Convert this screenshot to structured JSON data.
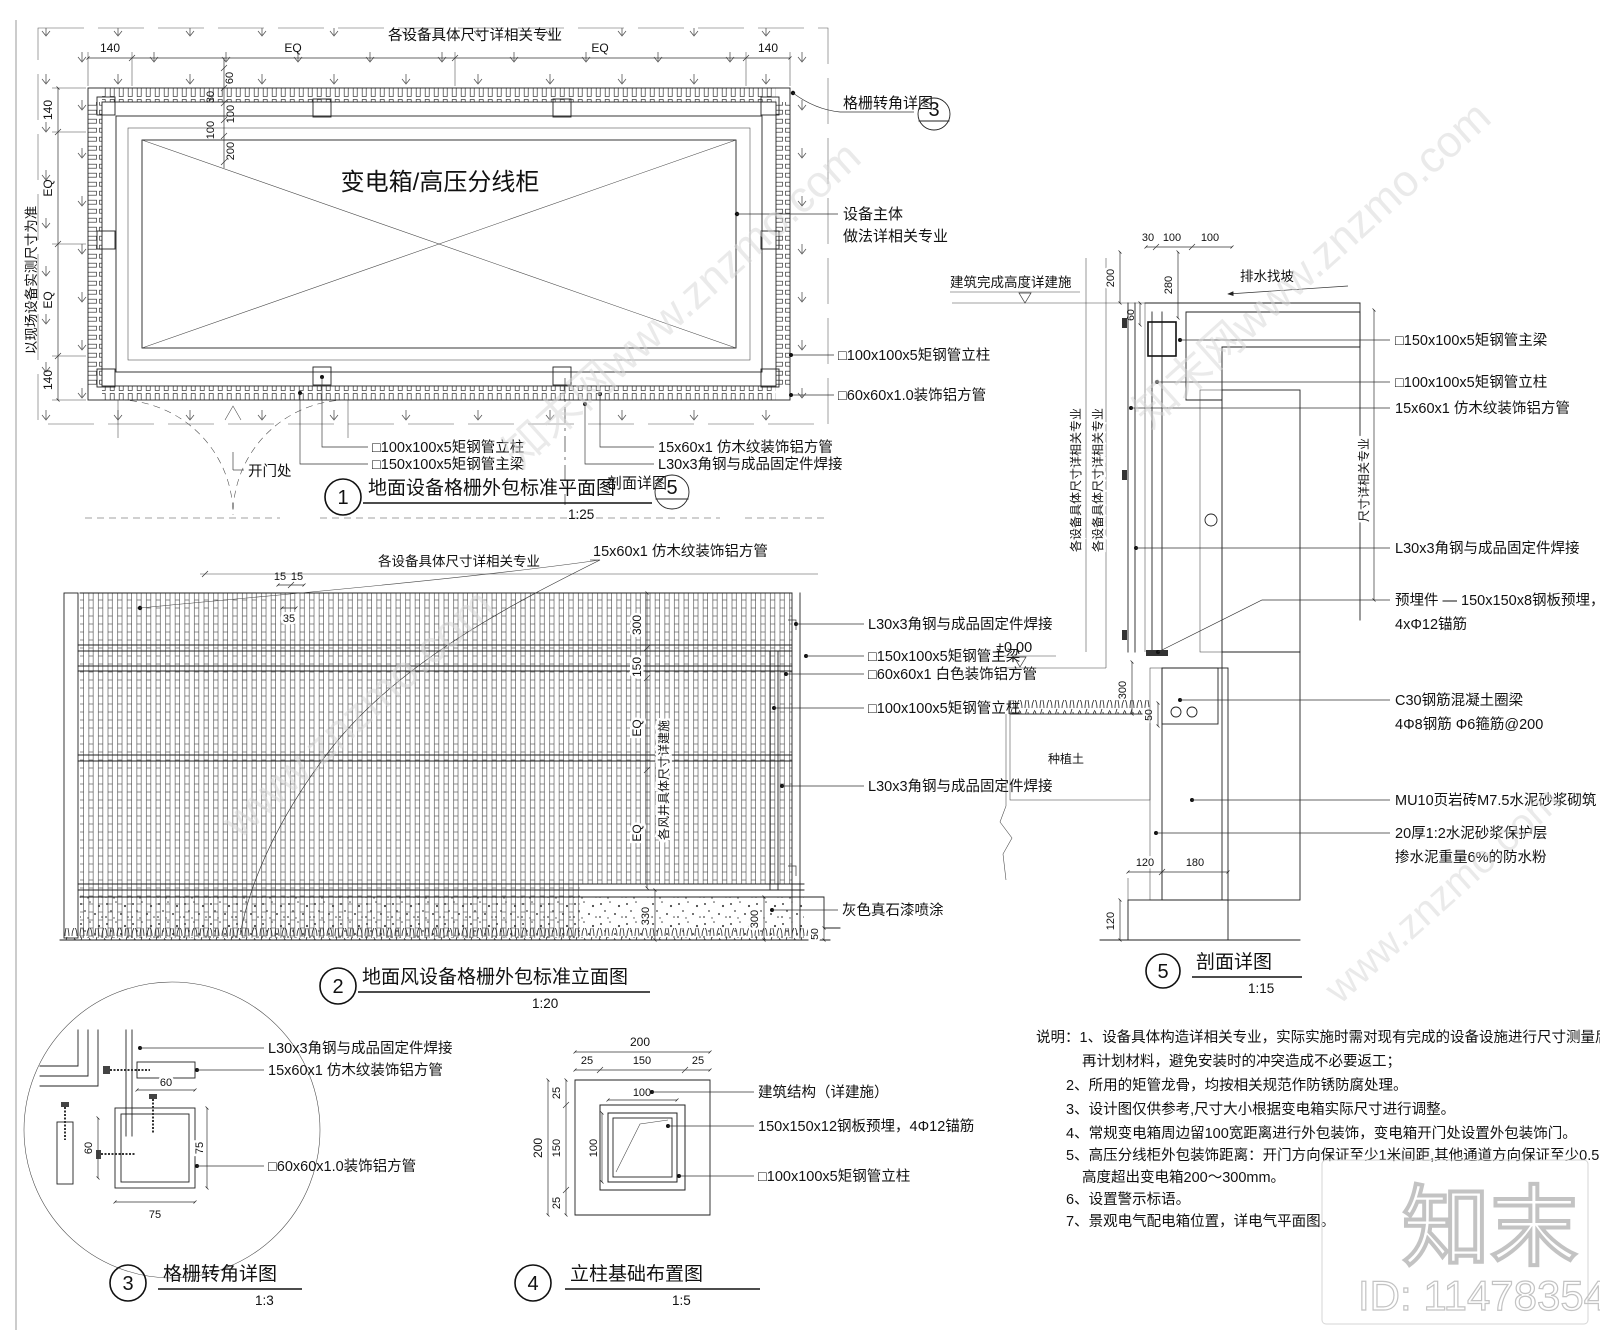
{
  "d1": {
    "num": "1",
    "title": "地面设备格栅外包标准平面图",
    "scale": "1:25",
    "top_note": "各设备具体尺寸详相关专业",
    "side_note": "以现场设备实测尺寸为准",
    "equipment": "变电箱/高压分线柜",
    "door": "开门处",
    "corner_callout": "格栅转角详图",
    "corner_num": "3",
    "section_callout": "剖面详图",
    "section_num": "5",
    "lbl_equip1": "设备主体",
    "lbl_equip2": "做法详相关专业",
    "lbl_post_r": "□100x100x5矩钢管立柱",
    "lbl_alu_r": "□60x60x1.0装饰铝方管",
    "lbl_post_b": "□100x100x5矩钢管立柱",
    "lbl_beam_b": "□150x100x5矩钢管主梁",
    "lbl_wood_b": "15x60x1 仿木纹装饰铝方管",
    "lbl_angle_b": "L30x3角钢与成品固定件焊接",
    "dim_140l": "140",
    "dim_eq1": "EQ",
    "dim_eq2": "EQ",
    "dim_140r": "140",
    "dim_v140a": "140",
    "dim_veq1": "EQ",
    "dim_veq2": "EQ",
    "dim_v140b": "140",
    "dim_60": "60",
    "dim_30": "30",
    "dim_100a": "100",
    "dim_100b": "100",
    "dim_200": "200"
  },
  "d2": {
    "num": "2",
    "title": "地面风设备格栅外包标准立面图",
    "scale": "1:20",
    "top_note": "各设备具体尺寸详相关专业",
    "lbl_wood_top": "15x60x1 仿木纹装饰铝方管",
    "dim_15a": "15",
    "dim_15b": "15",
    "dim_35": "35",
    "dim_300": "300",
    "dim_150": "150",
    "dim_eq1": "EQ",
    "dim_eq2": "EQ",
    "vent_note": "各风井具体尺寸详建施",
    "lbl_angle1": "L30x3角钢与成品固定件焊接",
    "lbl_beam": "□150x100x5矩钢管主梁",
    "lbl_white": "□60x60x1 白色装饰铝方管",
    "lbl_post": "□100x100x5矩钢管立柱",
    "lbl_angle2": "L30x3角钢与成品固定件焊接",
    "lbl_paint": "灰色真石漆喷涂",
    "dim_330": "330",
    "dim_300b": "300",
    "dim_50": "50"
  },
  "d3": {
    "num": "3",
    "title": "格栅转角详图",
    "scale": "1:3",
    "lbl_angle": "L30x3角钢与成品固定件焊接",
    "lbl_wood": "15x60x1 仿木纹装饰铝方管",
    "lbl_alu": "□60x60x1.0装饰铝方管",
    "dim_60t": "60",
    "dim_75r": "75",
    "dim_60l": "60",
    "dim_75b": "75"
  },
  "d4": {
    "num": "4",
    "title": "立柱基础布置图",
    "scale": "1:5",
    "lbl_struct": "建筑结构（详建施）",
    "lbl_plate": "150x150x12钢板预埋，4Φ12锚筋",
    "lbl_post": "□100x100x5矩钢管立柱",
    "dim_200t": "200",
    "dim_25a": "25",
    "dim_150t": "150",
    "dim_25b": "25",
    "dim_200l": "200",
    "dim_25c": "25",
    "dim_150l": "150",
    "dim_25d": "25",
    "dim_100h": "100",
    "dim_100v": "100"
  },
  "d5": {
    "num": "5",
    "title": "剖面详图",
    "scale": "1:15",
    "lbl_height": "建筑完成高度详建施",
    "lbl_slope": "排水找坡",
    "lbl_beam": "□150x100x5矩钢管主梁",
    "lbl_post": "□100x100x5矩钢管立柱",
    "lbl_wood": "15x60x1 仿木纹装饰铝方管",
    "lbl_angle": "L30x3角钢与成品固定件焊接",
    "lbl_embed1": "预埋件 — 150x150x8钢板预埋，",
    "lbl_embed2": "4xΦ12锚筋",
    "lbl_c30a": "C30钢筋混凝土圈梁",
    "lbl_c30b": "4Φ8钢筋  Φ6箍筋@200",
    "lbl_mu10": "MU10页岩砖M7.5水泥砂浆砌筑",
    "lbl_mortar1": "20厚1:2水泥砂浆保护层",
    "lbl_mortar2": "掺水泥重量6%的防水粉",
    "lbl_soil": "种植土",
    "lbl_zero": "±0.00",
    "note_v1": "各设备具体尺寸详相关专业",
    "note_v2": "各设备具体尺寸详相关专业",
    "note_v3": "尺寸详相关专业",
    "dim_30": "30",
    "dim_100a": "100",
    "dim_100b": "100",
    "dim_200": "200",
    "dim_280": "280",
    "dim_60": "60",
    "dim_300": "300",
    "dim_50": "50",
    "dim_120a": "120",
    "dim_180": "180",
    "dim_120b": "120"
  },
  "notes": {
    "lines": [
      "说明：1、设备具体构造详相关专业，实际实施时需对现有完成的设备设施进行尺寸测量后，",
      "再计划材料，避免安装时的冲突造成不必要返工；",
      "2、所用的矩管龙骨，均按相关规范作防锈防腐处理。",
      "3、设计图仅供参考,尺寸大小根据变电箱实际尺寸进行调整。",
      "4、常规变电箱周边留100宽距离进行外包装饰，变电箱开门处设置外包装饰门。",
      "5、高压分线柜外包装饰距离：开门方向保证至少1米间距,其他通道方向保证至少0.5～0.6米间距，",
      "高度超出变电箱200～300mm。",
      "6、设置警示标语。",
      "7、景观电气配电箱位置，详电气平面图。"
    ]
  },
  "watermark": {
    "logo": "知末",
    "id": "ID: 1147835468",
    "diag_a": "知末网www.znzmo.com",
    "diag_b": "www.znzmo.com"
  }
}
